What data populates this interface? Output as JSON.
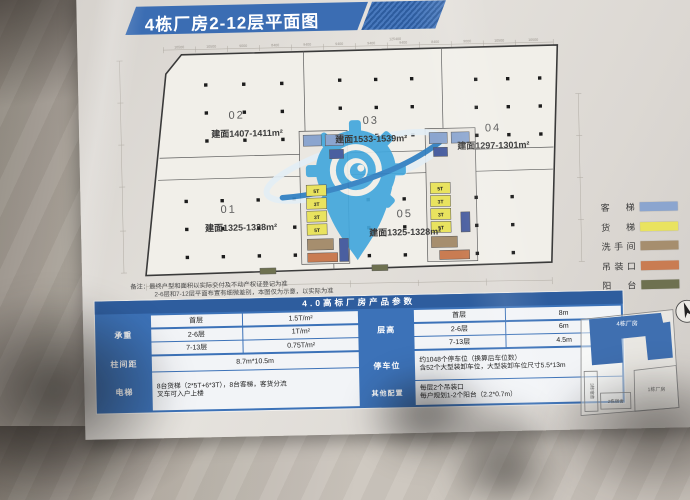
{
  "title": "4栋厂房2-12层平面图",
  "plan": {
    "units": [
      {
        "num": "01",
        "area": "建面1325-1328m²"
      },
      {
        "num": "02",
        "area": "建面1407-1411m²"
      },
      {
        "num": "03",
        "area": "建面1533-1539m²"
      },
      {
        "num": "04",
        "area": "建面1297-1301m²"
      },
      {
        "num": "05",
        "area": "建面1325-1328m²"
      }
    ],
    "lift_labels": [
      "5T",
      "3T",
      "3T",
      "5T"
    ],
    "dims_top": [
      "10500",
      "10500",
      "9000",
      "8400",
      "9400",
      "9400",
      "9400",
      "9400",
      "8400",
      "9000",
      "10500",
      "10500"
    ],
    "dim_total_top": "125400"
  },
  "legend": {
    "items": [
      {
        "label": "客梯",
        "color": "#8BA5CF"
      },
      {
        "label": "货梯",
        "color": "#E9E35F"
      },
      {
        "label": "洗手间",
        "color": "#A68E6E"
      },
      {
        "label": "吊装口",
        "color": "#C97C52"
      },
      {
        "label": "阳台",
        "color": "#6E7150"
      }
    ]
  },
  "notes": {
    "line1": "备注：最终户型和面积以实际交付及不动产权证登记为准",
    "line2": "2-6层和7-12层平面布置有细微差别，本图仅为示意，以实际为准"
  },
  "spec_table": {
    "header": "4.0高标厂房产品参数",
    "left": [
      {
        "label": "承重",
        "rows": [
          [
            "首层",
            "1.5T/m²"
          ],
          [
            "2-6层",
            "1T/m²"
          ],
          [
            "7-13层",
            "0.75T/m²"
          ]
        ]
      },
      {
        "label": "柱间距",
        "value": "8.7m*10.5m"
      },
      {
        "label": "电梯",
        "line1": "8台货梯（2*5T+6*3T），8台客梯，客货分流",
        "line2": "叉车可入户上楼"
      }
    ],
    "right": [
      {
        "label": "层高",
        "rows": [
          [
            "首层",
            "8m"
          ],
          [
            "2-6层",
            "6m"
          ],
          [
            "7-13层",
            "4.5m"
          ]
        ]
      },
      {
        "label": "停车位",
        "line1": "约1048个停车位（换算后车位数）",
        "line2": "含52个大型装卸车位，大型装卸车位尺寸5.5*13m"
      },
      {
        "label": "其他配置",
        "line1": "每层2个吊装口",
        "line2": "每户规划1-2个阳台（2.2*0.7m）"
      }
    ]
  },
  "keymap": {
    "buildings": [
      {
        "label": "4栋厂房"
      },
      {
        "label": "3栋宿舍"
      },
      {
        "label": "2栋宿舍"
      },
      {
        "label": "1栋厂房"
      }
    ]
  },
  "colors": {
    "accent_blue": "#3C72B8",
    "header_blue": "#2E5D9E",
    "passenger_blue": "#8BA5CF",
    "freight_yellow": "#E9E35F",
    "washroom_tan": "#A68E6E",
    "hoist_orange": "#C97C52",
    "balcony_olive": "#6E7150",
    "logo_blue": "#43A7DC"
  }
}
